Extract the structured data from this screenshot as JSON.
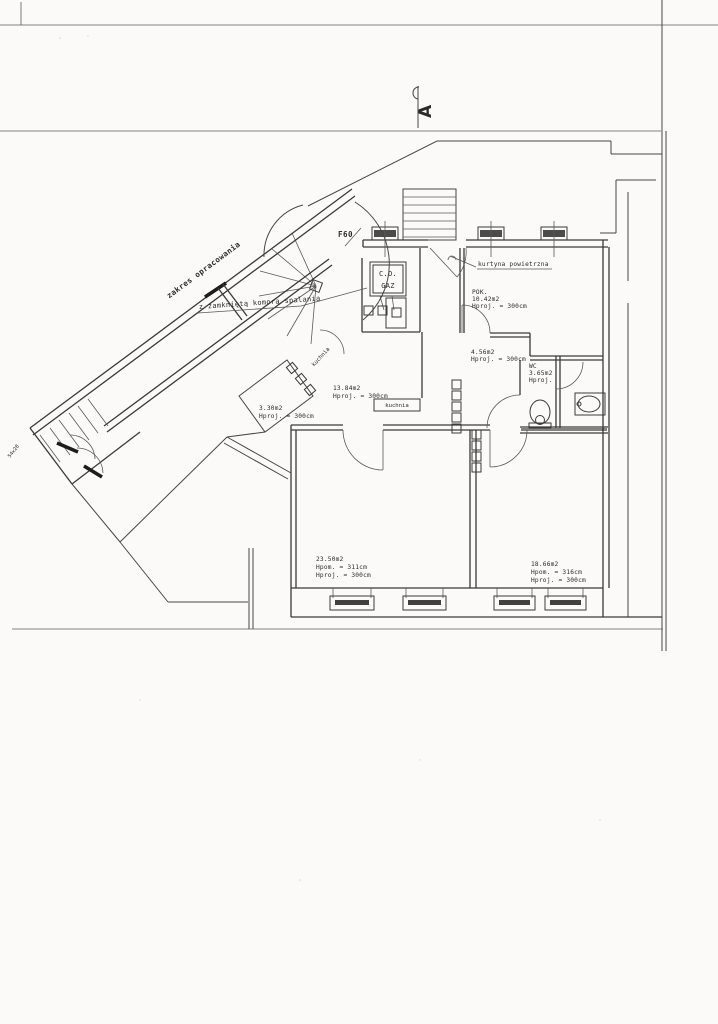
{
  "page": {
    "background": "#fbfaf8",
    "line_color": "#3a3a3a",
    "text_color": "#2b2b2b"
  },
  "section_marker": {
    "label": "A"
  },
  "annotations": {
    "scope": "zakres opracowania",
    "combustion": "z zamkniętą komorą spalania",
    "fire_door": "F60",
    "boiler_line1": "C.O.",
    "boiler_line2": "GAZ",
    "air_curtain": "kurtyna powietrzna",
    "stair_dim": "54x28",
    "kitchen_tag": "kuchnia",
    "kitchen_plate": "kuchnia"
  },
  "rooms": {
    "pok": {
      "name": "POK.",
      "area": "10.42m2",
      "height": "Hproj. = 300cm"
    },
    "hall": {
      "area": "4.56m2",
      "height": "Hproj. = 300cm"
    },
    "wc": {
      "name": "WC",
      "area": "3.65m2",
      "height": "Hproj."
    },
    "kitchen": {
      "area": "13.84m2",
      "height": "Hproj. = 300cm"
    },
    "store": {
      "area": "3.30m2",
      "height": "Hproj. = 300cm"
    },
    "room_left": {
      "area": "23.50m2",
      "height_room": "Hpom. = 311cm",
      "height_proj": "Hproj. = 300cm"
    },
    "room_right": {
      "area": "18.66m2",
      "height_room": "Hpom. = 316cm",
      "height_proj": "Hproj. = 300cm"
    }
  }
}
